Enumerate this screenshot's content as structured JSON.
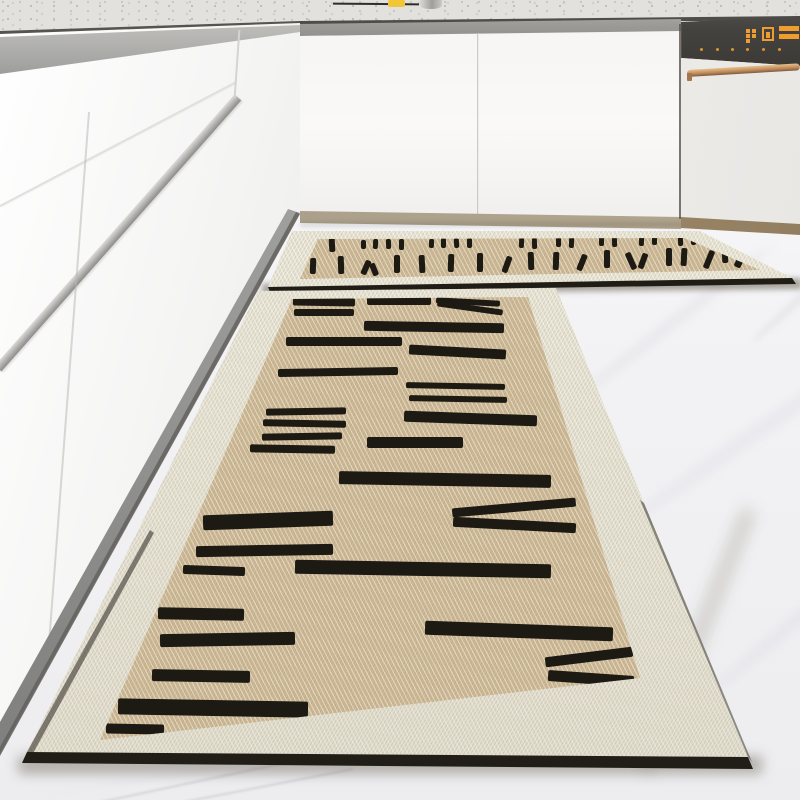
{
  "palette": {
    "ink": "#1d1a14",
    "mat_field_tan": "#ccb792",
    "mat_field_tan_deep": "#c0ab84",
    "mat_border_cream": "#e8e4d4",
    "mat_edge_black": "#211e18",
    "floor_white": "#f4f4f6",
    "cabinet_white": "#f8f7f5",
    "counter_speckle_base": "#e2e1dd",
    "toe_kick_tan": "#aba08b",
    "dishwasher_panel_gray": "#474540",
    "display_amber": "#ef9d2e",
    "handle_copper": "#c08c5c",
    "faucet_steel": "#b5b4b2",
    "sponge_yellow": "#f2c735"
  },
  "dishwasher": {
    "display": {
      "icons": [
        {
          "type": "dots",
          "x": 746,
          "y": 29
        },
        {
          "type": "box",
          "x": 762,
          "y": 27
        },
        {
          "type": "seg",
          "x": 779,
          "y": 26
        }
      ],
      "button_dots_y": 48,
      "button_dots_x": [
        700,
        716,
        731,
        746,
        762,
        778
      ]
    }
  },
  "mats": {
    "small": {
      "dashes": [
        [
          306,
          240,
          5,
          10,
          2
        ],
        [
          329,
          238,
          6,
          14,
          -3
        ],
        [
          361,
          240,
          5,
          9,
          0
        ],
        [
          373,
          239,
          5,
          10,
          3
        ],
        [
          386,
          239,
          5,
          10,
          -2
        ],
        [
          399,
          239,
          5,
          11,
          0
        ],
        [
          429,
          239,
          5,
          9,
          2
        ],
        [
          441,
          238,
          5,
          10,
          0
        ],
        [
          454,
          238,
          5,
          10,
          -3
        ],
        [
          467,
          238,
          5,
          10,
          0
        ],
        [
          519,
          238,
          5,
          10,
          2
        ],
        [
          532,
          238,
          5,
          11,
          -2
        ],
        [
          556,
          237,
          5,
          10,
          0
        ],
        [
          569,
          237,
          5,
          11,
          2
        ],
        [
          599,
          236,
          5,
          10,
          0
        ],
        [
          612,
          236,
          5,
          11,
          -2
        ],
        [
          639,
          236,
          5,
          10,
          2
        ],
        [
          652,
          235,
          5,
          10,
          0
        ],
        [
          678,
          235,
          5,
          11,
          -2
        ],
        [
          691,
          235,
          5,
          10,
          0
        ],
        [
          705,
          234,
          6,
          12,
          2
        ],
        [
          718,
          234,
          5,
          10,
          0
        ],
        [
          310,
          258,
          6,
          16,
          2
        ],
        [
          338,
          256,
          6,
          18,
          -2
        ],
        [
          363,
          260,
          6,
          15,
          24
        ],
        [
          371,
          263,
          6,
          13,
          -22
        ],
        [
          394,
          255,
          6,
          18,
          0
        ],
        [
          419,
          255,
          6,
          18,
          -3
        ],
        [
          448,
          254,
          6,
          18,
          2
        ],
        [
          477,
          253,
          6,
          19,
          0
        ],
        [
          504,
          256,
          6,
          17,
          20
        ],
        [
          528,
          252,
          6,
          18,
          -2
        ],
        [
          553,
          252,
          6,
          18,
          2
        ],
        [
          579,
          254,
          6,
          17,
          22
        ],
        [
          604,
          250,
          6,
          18,
          0
        ],
        [
          628,
          252,
          6,
          18,
          -24
        ],
        [
          640,
          253,
          6,
          16,
          20
        ],
        [
          666,
          248,
          6,
          18,
          0
        ],
        [
          681,
          248,
          6,
          18,
          3
        ],
        [
          706,
          250,
          6,
          19,
          22
        ],
        [
          722,
          247,
          6,
          16,
          -2
        ],
        [
          737,
          250,
          7,
          18,
          25
        ]
      ]
    },
    "large": {
      "bars": [
        [
          293,
          298,
          62,
          8,
          1
        ],
        [
          294,
          309,
          60,
          7,
          0
        ],
        [
          286,
          337,
          116,
          9,
          0
        ],
        [
          278,
          368,
          120,
          8,
          -1
        ],
        [
          266,
          408,
          80,
          7,
          -1
        ],
        [
          263,
          420,
          83,
          7,
          1
        ],
        [
          262,
          433,
          80,
          7,
          -1
        ],
        [
          250,
          445,
          85,
          8,
          1
        ],
        [
          203,
          513,
          130,
          15,
          -2
        ],
        [
          196,
          545,
          137,
          11,
          -1
        ],
        [
          183,
          566,
          62,
          9,
          2
        ],
        [
          158,
          608,
          86,
          12,
          1
        ],
        [
          160,
          633,
          135,
          13,
          -1
        ],
        [
          152,
          670,
          98,
          12,
          1
        ],
        [
          118,
          700,
          190,
          16,
          1
        ],
        [
          106,
          724,
          58,
          10,
          1
        ],
        [
          367,
          297,
          64,
          8,
          0
        ],
        [
          436,
          299,
          64,
          6,
          3
        ],
        [
          437,
          305,
          66,
          6,
          8
        ],
        [
          364,
          322,
          140,
          10,
          1
        ],
        [
          409,
          347,
          97,
          10,
          3
        ],
        [
          406,
          383,
          99,
          6,
          1
        ],
        [
          409,
          396,
          98,
          6,
          1
        ],
        [
          404,
          413,
          133,
          11,
          2
        ],
        [
          367,
          437,
          96,
          11,
          0
        ],
        [
          339,
          473,
          212,
          13,
          1
        ],
        [
          452,
          503,
          124,
          9,
          -5
        ],
        [
          453,
          520,
          123,
          10,
          3
        ],
        [
          295,
          562,
          256,
          14,
          1
        ],
        [
          425,
          624,
          188,
          14,
          2
        ],
        [
          545,
          652,
          88,
          10,
          -7
        ],
        [
          548,
          673,
          86,
          11,
          4
        ]
      ]
    }
  }
}
